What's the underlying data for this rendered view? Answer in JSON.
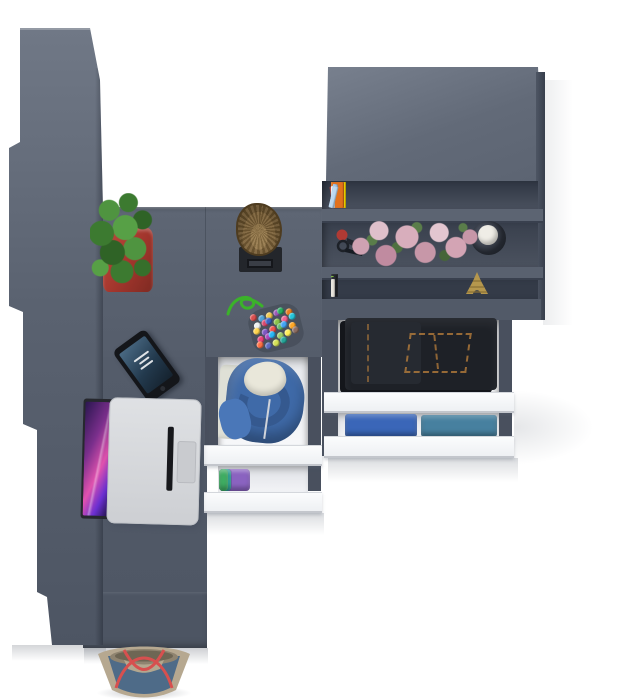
{
  "scene": {
    "type": "3d-furniture-render",
    "view": "top-down"
  },
  "palette": {
    "furniture_gray": "#565e6c",
    "furniture_gray_dark": "#3a414f",
    "furniture_gray_light": "#6e7684",
    "shelf_interior": "#353c49",
    "drawer_front_white": "#f6f7f9",
    "drawer_rail": "#4b5260",
    "floor_white": "#ffffff",
    "pot_red": "#b23b33",
    "cactus_green": "#3f7d30",
    "log_wood": "#8a6f45",
    "flower_pink": "#cfa2b2",
    "candle_white": "#efede6",
    "eiffel_gold": "#b5974d",
    "jeans_denim": "#1e2127",
    "jeans_stitch": "#b07a36",
    "hoodie_blue": "#3f6aa8",
    "hoodie_lining": "#e9e7da",
    "laptop_silver": "#d7d9dc",
    "laptop_key_black": "#17181c",
    "laptop_screen_pink": "#e052ae",
    "phone_black": "#14161a",
    "bead_cord_green": "#3bb22a",
    "bag_denim": "#4e6b88",
    "bag_trim": "#b6a890",
    "bag_strap_red": "#d7504f"
  },
  "bookshelf": {
    "top_shelf": {
      "books": [
        {
          "c": "#a93226",
          "w": 7,
          "h": 22,
          "r": -8
        },
        {
          "c": "#d64541",
          "w": 5,
          "h": 24
        },
        {
          "c": "#3a62c4",
          "w": 6,
          "h": 21
        },
        {
          "c": "#eae6df",
          "w": 5,
          "h": 23
        },
        {
          "c": "#58a849",
          "w": 4,
          "h": 20
        },
        {
          "c": "#f2d400",
          "w": 15,
          "h": 26,
          "label": "333"
        },
        {
          "c": "#f2d400",
          "w": 15,
          "h": 26,
          "label": "333"
        },
        {
          "c": "#f2d400",
          "w": 15,
          "h": 26,
          "label": "333"
        },
        {
          "c": "#e2561f",
          "w": 6,
          "h": 22
        },
        {
          "c": "#8db8e8",
          "w": 5,
          "h": 24
        },
        {
          "c": "#e88bb1",
          "w": 5,
          "h": 23
        },
        {
          "c": "#3f6fd1",
          "w": 6,
          "h": 24
        },
        {
          "c": "#d6336c",
          "w": 5,
          "h": 22
        },
        {
          "c": "#f0ece6",
          "w": 4,
          "h": 21
        },
        {
          "c": "#b03330",
          "w": 8,
          "h": 25
        },
        {
          "c": "#e2711d",
          "w": 13,
          "h": 26
        },
        {
          "c": "#f5f1ea",
          "w": 4,
          "h": 22
        },
        {
          "c": "#9ec4ea",
          "w": 5,
          "h": 24,
          "r": 10
        },
        {
          "c": "#bcd8f0",
          "w": 5,
          "h": 22,
          "r": 14
        }
      ]
    },
    "middle_shelf": {
      "items": [
        "rose-bouquet",
        "key-ring",
        "candle-holder"
      ]
    },
    "bottom_shelf": {
      "books": [
        {
          "c": "#caa84a",
          "w": 5,
          "h": 20
        },
        {
          "c": "#23262c",
          "w": 6,
          "h": 22
        },
        {
          "c": "#f0eee8",
          "w": 4,
          "h": 19
        },
        {
          "c": "#1f2227",
          "w": 7,
          "h": 23
        },
        {
          "c": "#8a3f9e",
          "w": 5,
          "h": 21
        },
        {
          "c": "#23262c",
          "w": 6,
          "h": 22
        },
        {
          "c": "#d8d4cc",
          "w": 4,
          "h": 20
        },
        {
          "c": "#1f4f46",
          "w": 6,
          "h": 22
        },
        {
          "c": "#23262c",
          "w": 5,
          "h": 21
        },
        {
          "c": "#caa84a",
          "w": 4,
          "h": 19
        },
        {
          "c": "#2b2e35",
          "w": 7,
          "h": 23
        },
        {
          "c": "#2e7d66",
          "w": 5,
          "h": 21
        },
        {
          "c": "#b8b43c",
          "w": 4,
          "h": 20
        },
        {
          "c": "#23262c",
          "w": 6,
          "h": 22
        },
        {
          "c": "#88d440",
          "w": 3,
          "h": 21
        },
        {
          "c": "#2b2e35",
          "w": 5,
          "h": 20
        },
        {
          "c": "#e8e4dc",
          "w": 4,
          "h": 18
        }
      ],
      "ornament": "eiffel-tower-figurine"
    }
  },
  "drawers": {
    "center_unit": {
      "drawer1_contents": "blue-hoodie-with-cream-lining",
      "drawer2_contents": "folded-shirts",
      "stack": [
        {
          "c": "#d66a9e",
          "w": 13
        },
        {
          "c": "#2aa193",
          "w": 19
        },
        {
          "c": "#8a63c0",
          "w": 31
        },
        {
          "c": "#6b4fae",
          "w": 13
        },
        {
          "c": "#2aa193",
          "w": 12
        },
        {
          "c": "#3fae63",
          "w": 9
        }
      ]
    },
    "right_unit": {
      "drawer1_contents": "folded-dark-jeans",
      "drawer2_contents": "denim-shirts",
      "blue_stack": [
        {
          "c": "#3a66b8"
        },
        {
          "c": "#47809f"
        }
      ]
    }
  },
  "desk_items": [
    "laptop",
    "smartphone",
    "cactus-in-red-pot",
    "log-stool",
    "bead-charm"
  ],
  "decor": {
    "bead_charm": {
      "cord_color": "#3bb22a",
      "bead_colors": [
        "#d94f4f",
        "#4fa3d9",
        "#f2c94c",
        "#9b59b6",
        "#27ae60",
        "#e67e22",
        "#ecf0f1",
        "#d9486e",
        "#3a62c4",
        "#8bc34a",
        "#f06292",
        "#26c6da",
        "#ffd54f",
        "#7e57c2",
        "#ef5350",
        "#66bb6a",
        "#42a5f5",
        "#ffa726",
        "#ec407a",
        "#ab47bc",
        "#29b6f6",
        "#9ccc65",
        "#ffee58",
        "#8d6e63",
        "#ff7043",
        "#5c6bc0",
        "#d4e157",
        "#26a69a"
      ]
    },
    "tote_bag": {
      "body_color": "#4e6b88",
      "trim_color": "#b6a890",
      "strap_color": "#d7504f"
    }
  }
}
